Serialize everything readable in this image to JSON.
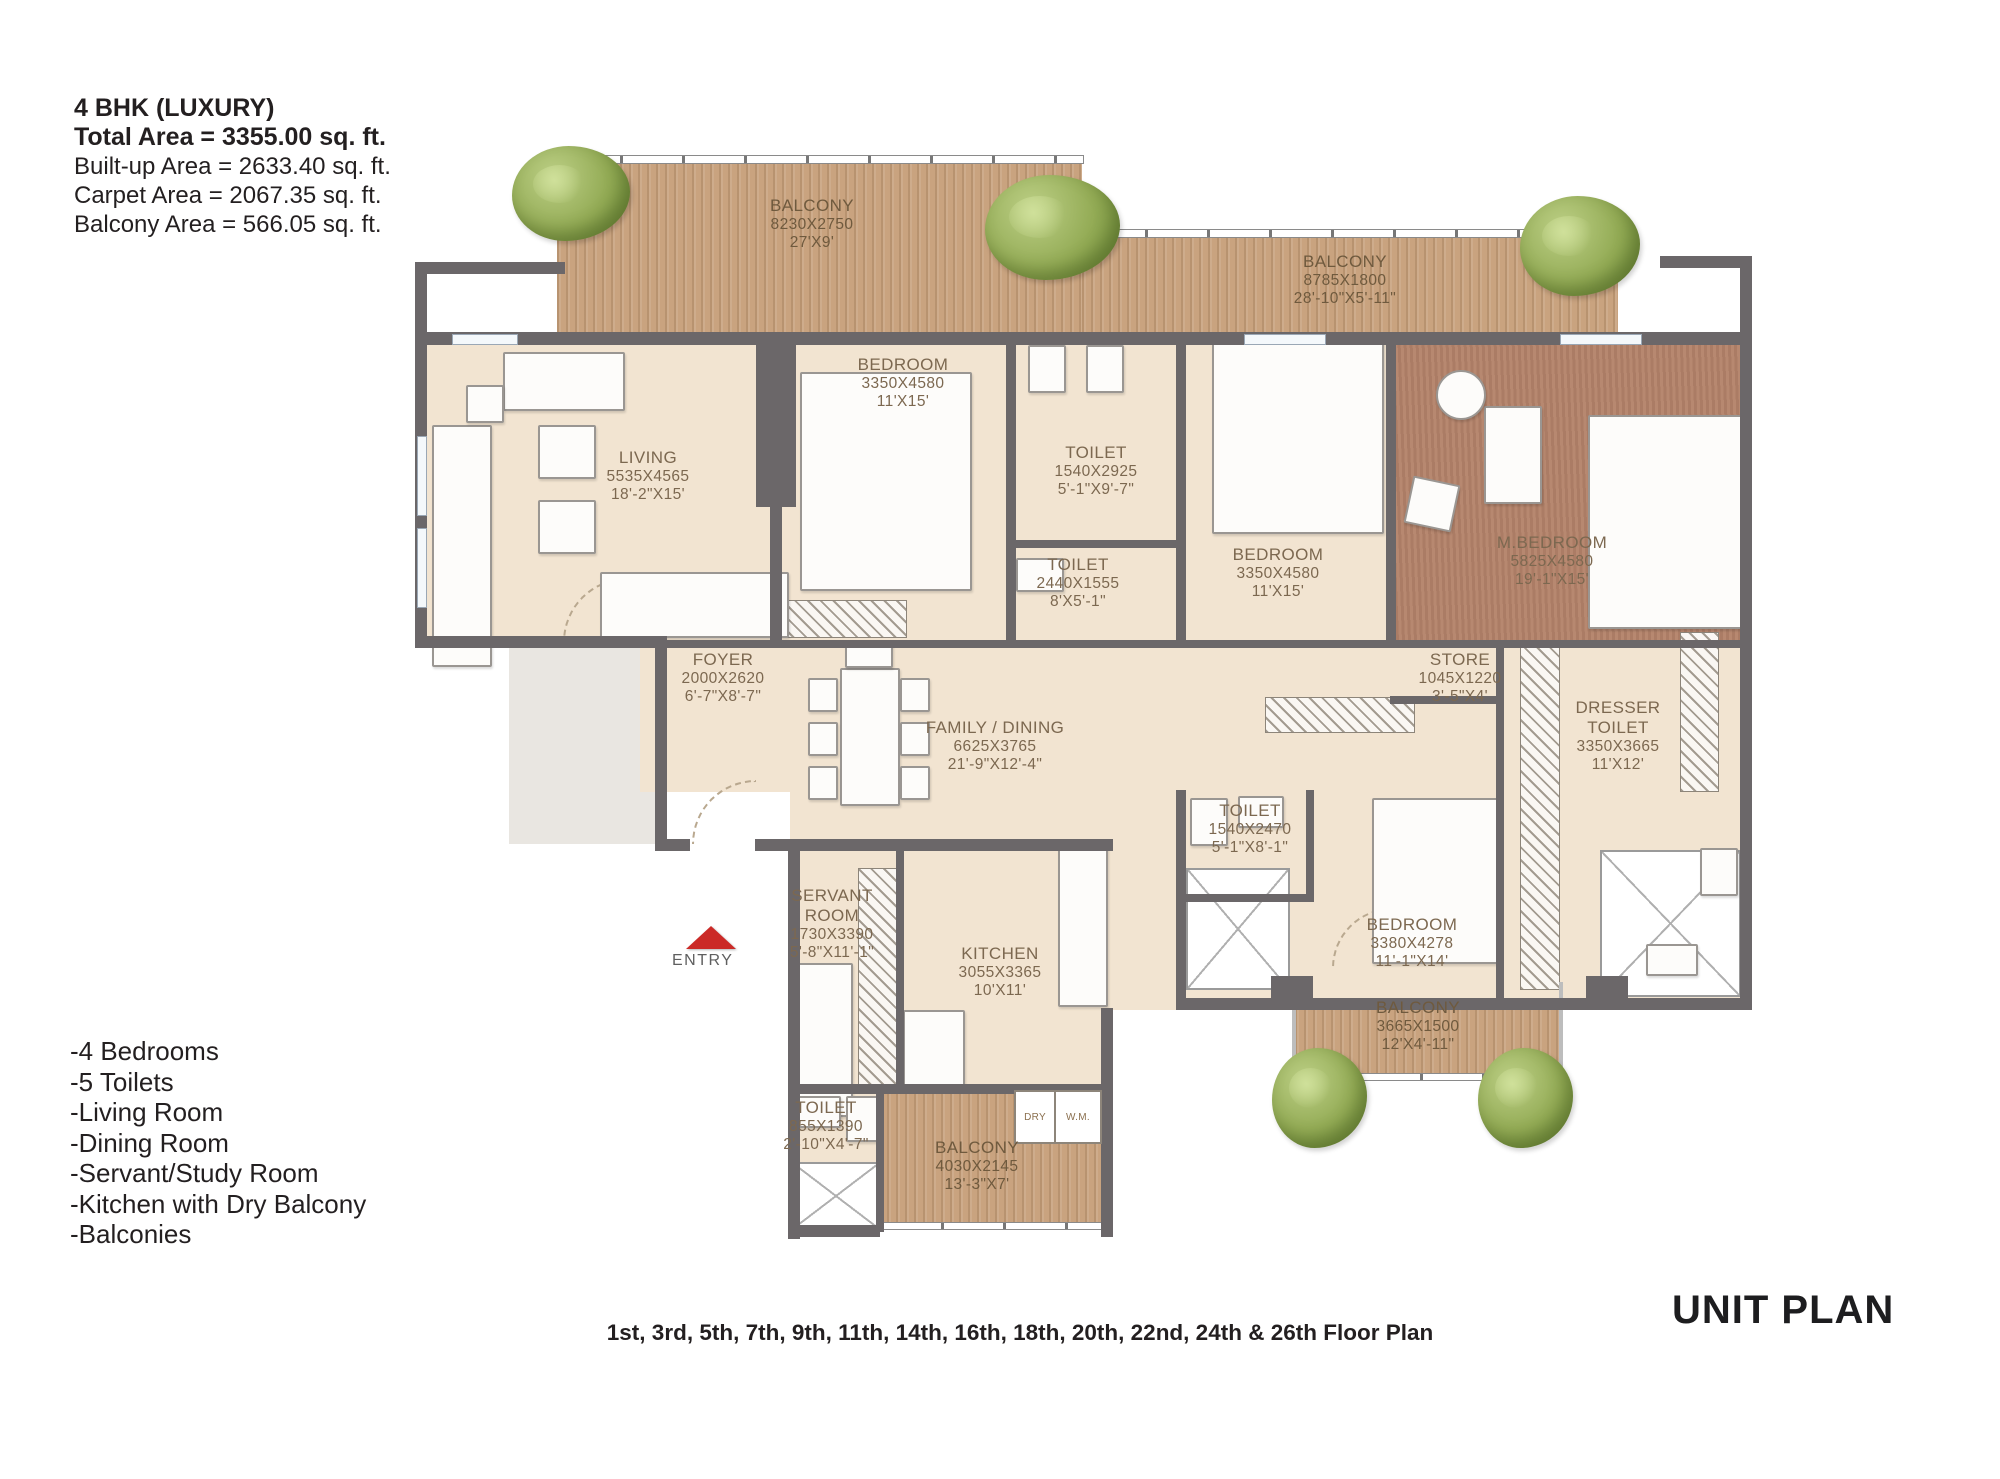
{
  "header": {
    "title": "4 BHK (LUXURY)",
    "total_area": "Total Area = 3355.00 sq. ft.",
    "built_up_area": "Built-up Area = 2633.40 sq. ft.",
    "carpet_area": "Carpet Area = 2067.35 sq. ft.",
    "balcony_area": "Balcony Area = 566.05 sq. ft."
  },
  "features": [
    "-4 Bedrooms",
    "-5 Toilets",
    "-Living Room",
    "-Dining Room",
    "-Servant/Study Room",
    "-Kitchen with Dry Balcony",
    "-Balconies"
  ],
  "footer": {
    "floors_note": "1st, 3rd, 5th, 7th, 9th, 11th, 14th, 16th, 18th, 20th, 22nd, 24th & 26th Floor Plan",
    "plan_label": "UNIT PLAN"
  },
  "entry_label": "ENTRY",
  "small_labels": {
    "dry": "DRY",
    "wm": "W.M."
  },
  "rooms": [
    {
      "name": "BALCONY",
      "size_mm": "8230X2750",
      "size_ft": "27'X9'"
    },
    {
      "name": "BALCONY",
      "size_mm": "8785X1800",
      "size_ft": "28'-10\"X5'-11\""
    },
    {
      "name": "LIVING",
      "size_mm": "5535X4565",
      "size_ft": "18'-2\"X15'"
    },
    {
      "name": "BEDROOM",
      "size_mm": "3350X4580",
      "size_ft": "11'X15'"
    },
    {
      "name": "TOILET",
      "size_mm": "1540X2925",
      "size_ft": "5'-1\"X9'-7\""
    },
    {
      "name": "TOILET",
      "size_mm": "2440X1555",
      "size_ft": "8'X5'-1\""
    },
    {
      "name": "BEDROOM",
      "size_mm": "3350X4580",
      "size_ft": "11'X15'"
    },
    {
      "name": "M.BEDROOM",
      "size_mm": "5825X4580",
      "size_ft": "19'-1\"X15'"
    },
    {
      "name": "FOYER",
      "size_mm": "2000X2620",
      "size_ft": "6'-7\"X8'-7\""
    },
    {
      "name": "FAMILY / DINING",
      "size_mm": "6625X3765",
      "size_ft": "21'-9\"X12'-4\""
    },
    {
      "name": "STORE",
      "size_mm": "1045X1220",
      "size_ft": "3'-5\"X4'"
    },
    {
      "name": "DRESSER\nTOILET",
      "size_mm": "3350X3665",
      "size_ft": "11'X12'"
    },
    {
      "name": "TOILET",
      "size_mm": "1540X2470",
      "size_ft": "5'-1\"X8'-1\""
    },
    {
      "name": "BEDROOM",
      "size_mm": "3380X4278",
      "size_ft": "11'-1\"X14'"
    },
    {
      "name": "SERVANT\nROOM",
      "size_mm": "1730X3390",
      "size_ft": "5'-8\"X11'-1\""
    },
    {
      "name": "KITCHEN",
      "size_mm": "3055X3365",
      "size_ft": "10'X11'"
    },
    {
      "name": "TOILET",
      "size_mm": "855X1390",
      "size_ft": "2'-10\"X4'-7\""
    },
    {
      "name": "BALCONY",
      "size_mm": "4030X2145",
      "size_ft": "13'-3\"X7'"
    },
    {
      "name": "BALCONY",
      "size_mm": "3665X1500",
      "size_ft": "12'X4'-11\""
    }
  ],
  "colors": {
    "wall": "#6b6769",
    "floor": "#f2e4d1",
    "balcony_wood": "#c9a37f",
    "master_bedroom_floor": "#b4836a",
    "entry_arrow": "#cb2a27",
    "label_text": "#7c6850"
  }
}
